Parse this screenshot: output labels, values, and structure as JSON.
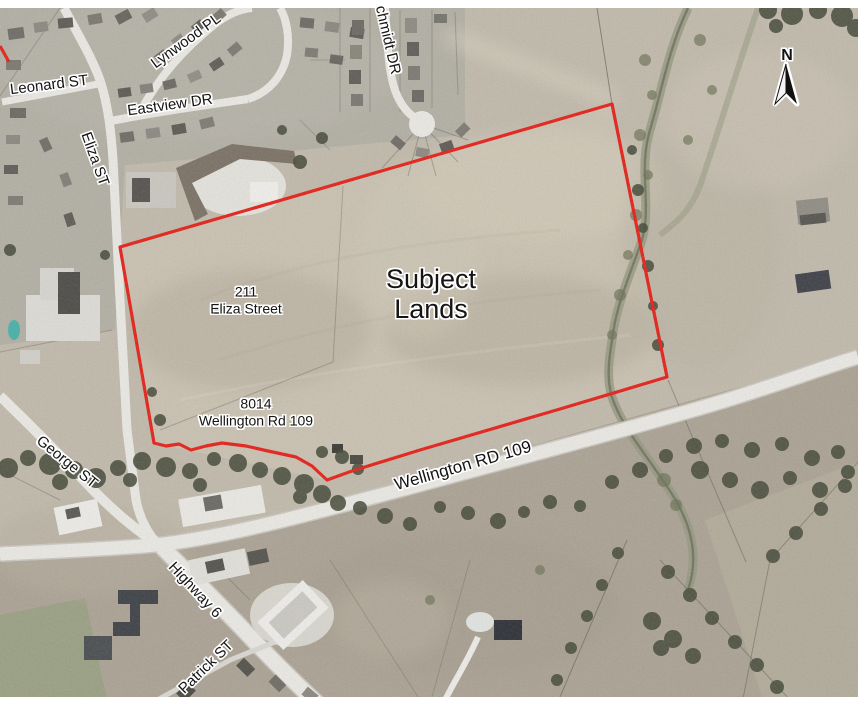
{
  "map": {
    "type": "aerial-photo-figure",
    "north_label": "N",
    "boundary_color": "#e32119",
    "subject_label": {
      "line1": "Subject",
      "line2": "Lands"
    },
    "parcel_211": {
      "line1": "211",
      "line2": "Eliza Street"
    },
    "parcel_8014": {
      "line1": "8014",
      "line2": "Wellington Rd 109"
    },
    "streets": {
      "leonard": "Leonard ST",
      "lynwood": "Lynwood PL",
      "eastview": "Eastview DR",
      "eliza": "Eliza ST",
      "schmidt": "chmidt DR",
      "wellington": "Wellington RD 109",
      "george": "George ST",
      "highway": "Highway 6",
      "patrick": "Patrick ST"
    }
  }
}
